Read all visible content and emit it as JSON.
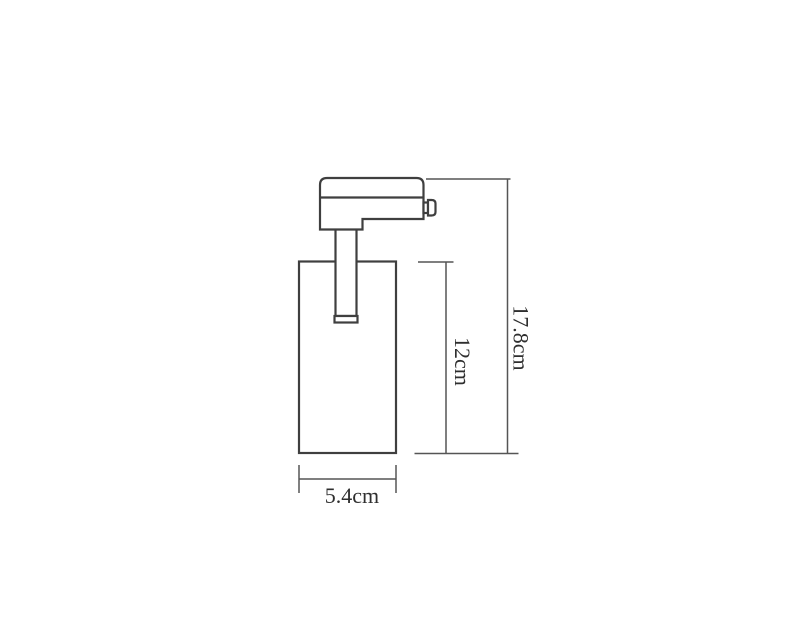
{
  "diagram": {
    "kind": "product-dimension-drawing",
    "subject": "track-light-spotlight-fixture",
    "dimensions": {
      "overall_height": "17.8cm",
      "body_height": "12cm",
      "body_width": "5.4cm"
    },
    "colors": {
      "background": "#ffffff",
      "outline": "#3f3f3f",
      "dimension_line": "#555555",
      "text": "#2f2f2f"
    }
  }
}
